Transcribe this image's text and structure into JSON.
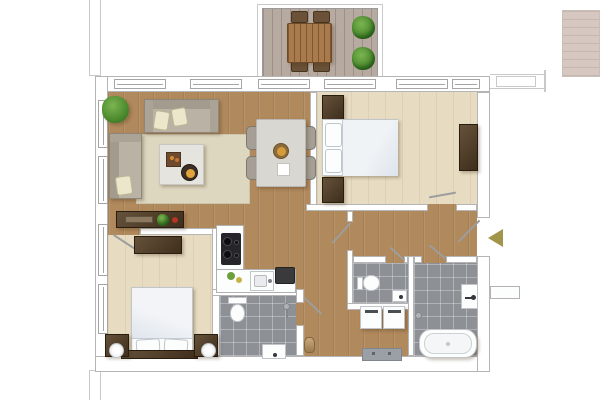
{
  "plan": {
    "title": "Two-bedroom apartment floor plan, top-down 2D rendering, no text labels",
    "entrance": {
      "label": "Entrance (gold arrow pointing into apartment from right side)",
      "direction": "left"
    },
    "rooms": [
      {
        "id": "balcony",
        "label": "Balcony with wooden dining table, four chairs and two shrubs"
      },
      {
        "id": "living-dining",
        "label": "Open living and dining room with two sofas, rug, coffee table and dining set"
      },
      {
        "id": "kitchen",
        "label": "Open kitchen with L-shaped counter, hob and sink"
      },
      {
        "id": "bedroom-1",
        "label": "Bedroom top-right with double bed, nightstands and wardrobe"
      },
      {
        "id": "bedroom-2",
        "label": "Bedroom bottom-left with double bed, nightstands, lamps and desk"
      },
      {
        "id": "shower-room",
        "label": "Shower room with toilet and washbasin"
      },
      {
        "id": "wc",
        "label": "Small WC with toilet and corner basin"
      },
      {
        "id": "bathroom",
        "label": "Bathroom with bathtub and washbasin"
      },
      {
        "id": "hallway",
        "label": "Entrance hallway with washer and dryer"
      }
    ],
    "furniture": {
      "sofa_large": "Three-seat sofa with two cream cushions",
      "sofa_small": "Two-seat sofa with cream cushion",
      "rug": "Beige area rug",
      "coffee_table": "Square coffee table with tray and bowl",
      "sideboard": "Dark wood sideboard with tray, plant and candle",
      "dining_table": "Square dining table with fruit bowl, plate and four chairs",
      "bed_1": "Double bed, white duvet, two pillows, dark nightstands",
      "wardrobe": "Dark wood wardrobe / dresser",
      "bed_2": "Double bed, white duvet, two pillows, nightstands with round lamps",
      "desk": "Dark wood desk",
      "hob": "Black four-burner hob",
      "sink": "Kitchen sink",
      "appliance": "Dark countertop appliance",
      "toilet": "Toilet",
      "washbasin": "Washbasin",
      "bathtub": "Freestanding bathtub",
      "shower": "Shower fitting",
      "washer": "Washing machine",
      "dryer": "Dryer",
      "radiator": "Radiator / bench",
      "balcony_table": "Slatted wooden outdoor table",
      "balcony_chair": "Outdoor chair",
      "shrub": "Green shrub",
      "houseplant": "Green houseplant",
      "decor": "Tan decor item"
    },
    "colors": {
      "wood": "#b0895c",
      "bedroomFloor": "#e7dcc2",
      "tile": "#8d9196",
      "wallFill": "#ffffff",
      "wallLine": "#b5b5b5",
      "sketch": "#c9c9c9",
      "deck": "#b7aba1",
      "tableWood": "#a87a4c",
      "sofa": "#b9b2a5",
      "sofaEdge": "#8d8679",
      "cushion": "#ece7cb",
      "rug": "#ddd7c0",
      "darkWood": "#54422e",
      "fixtureEdge": "#bfc5c9",
      "plant": "#4c8a2e",
      "arrowGold": "#a2954a"
    }
  }
}
